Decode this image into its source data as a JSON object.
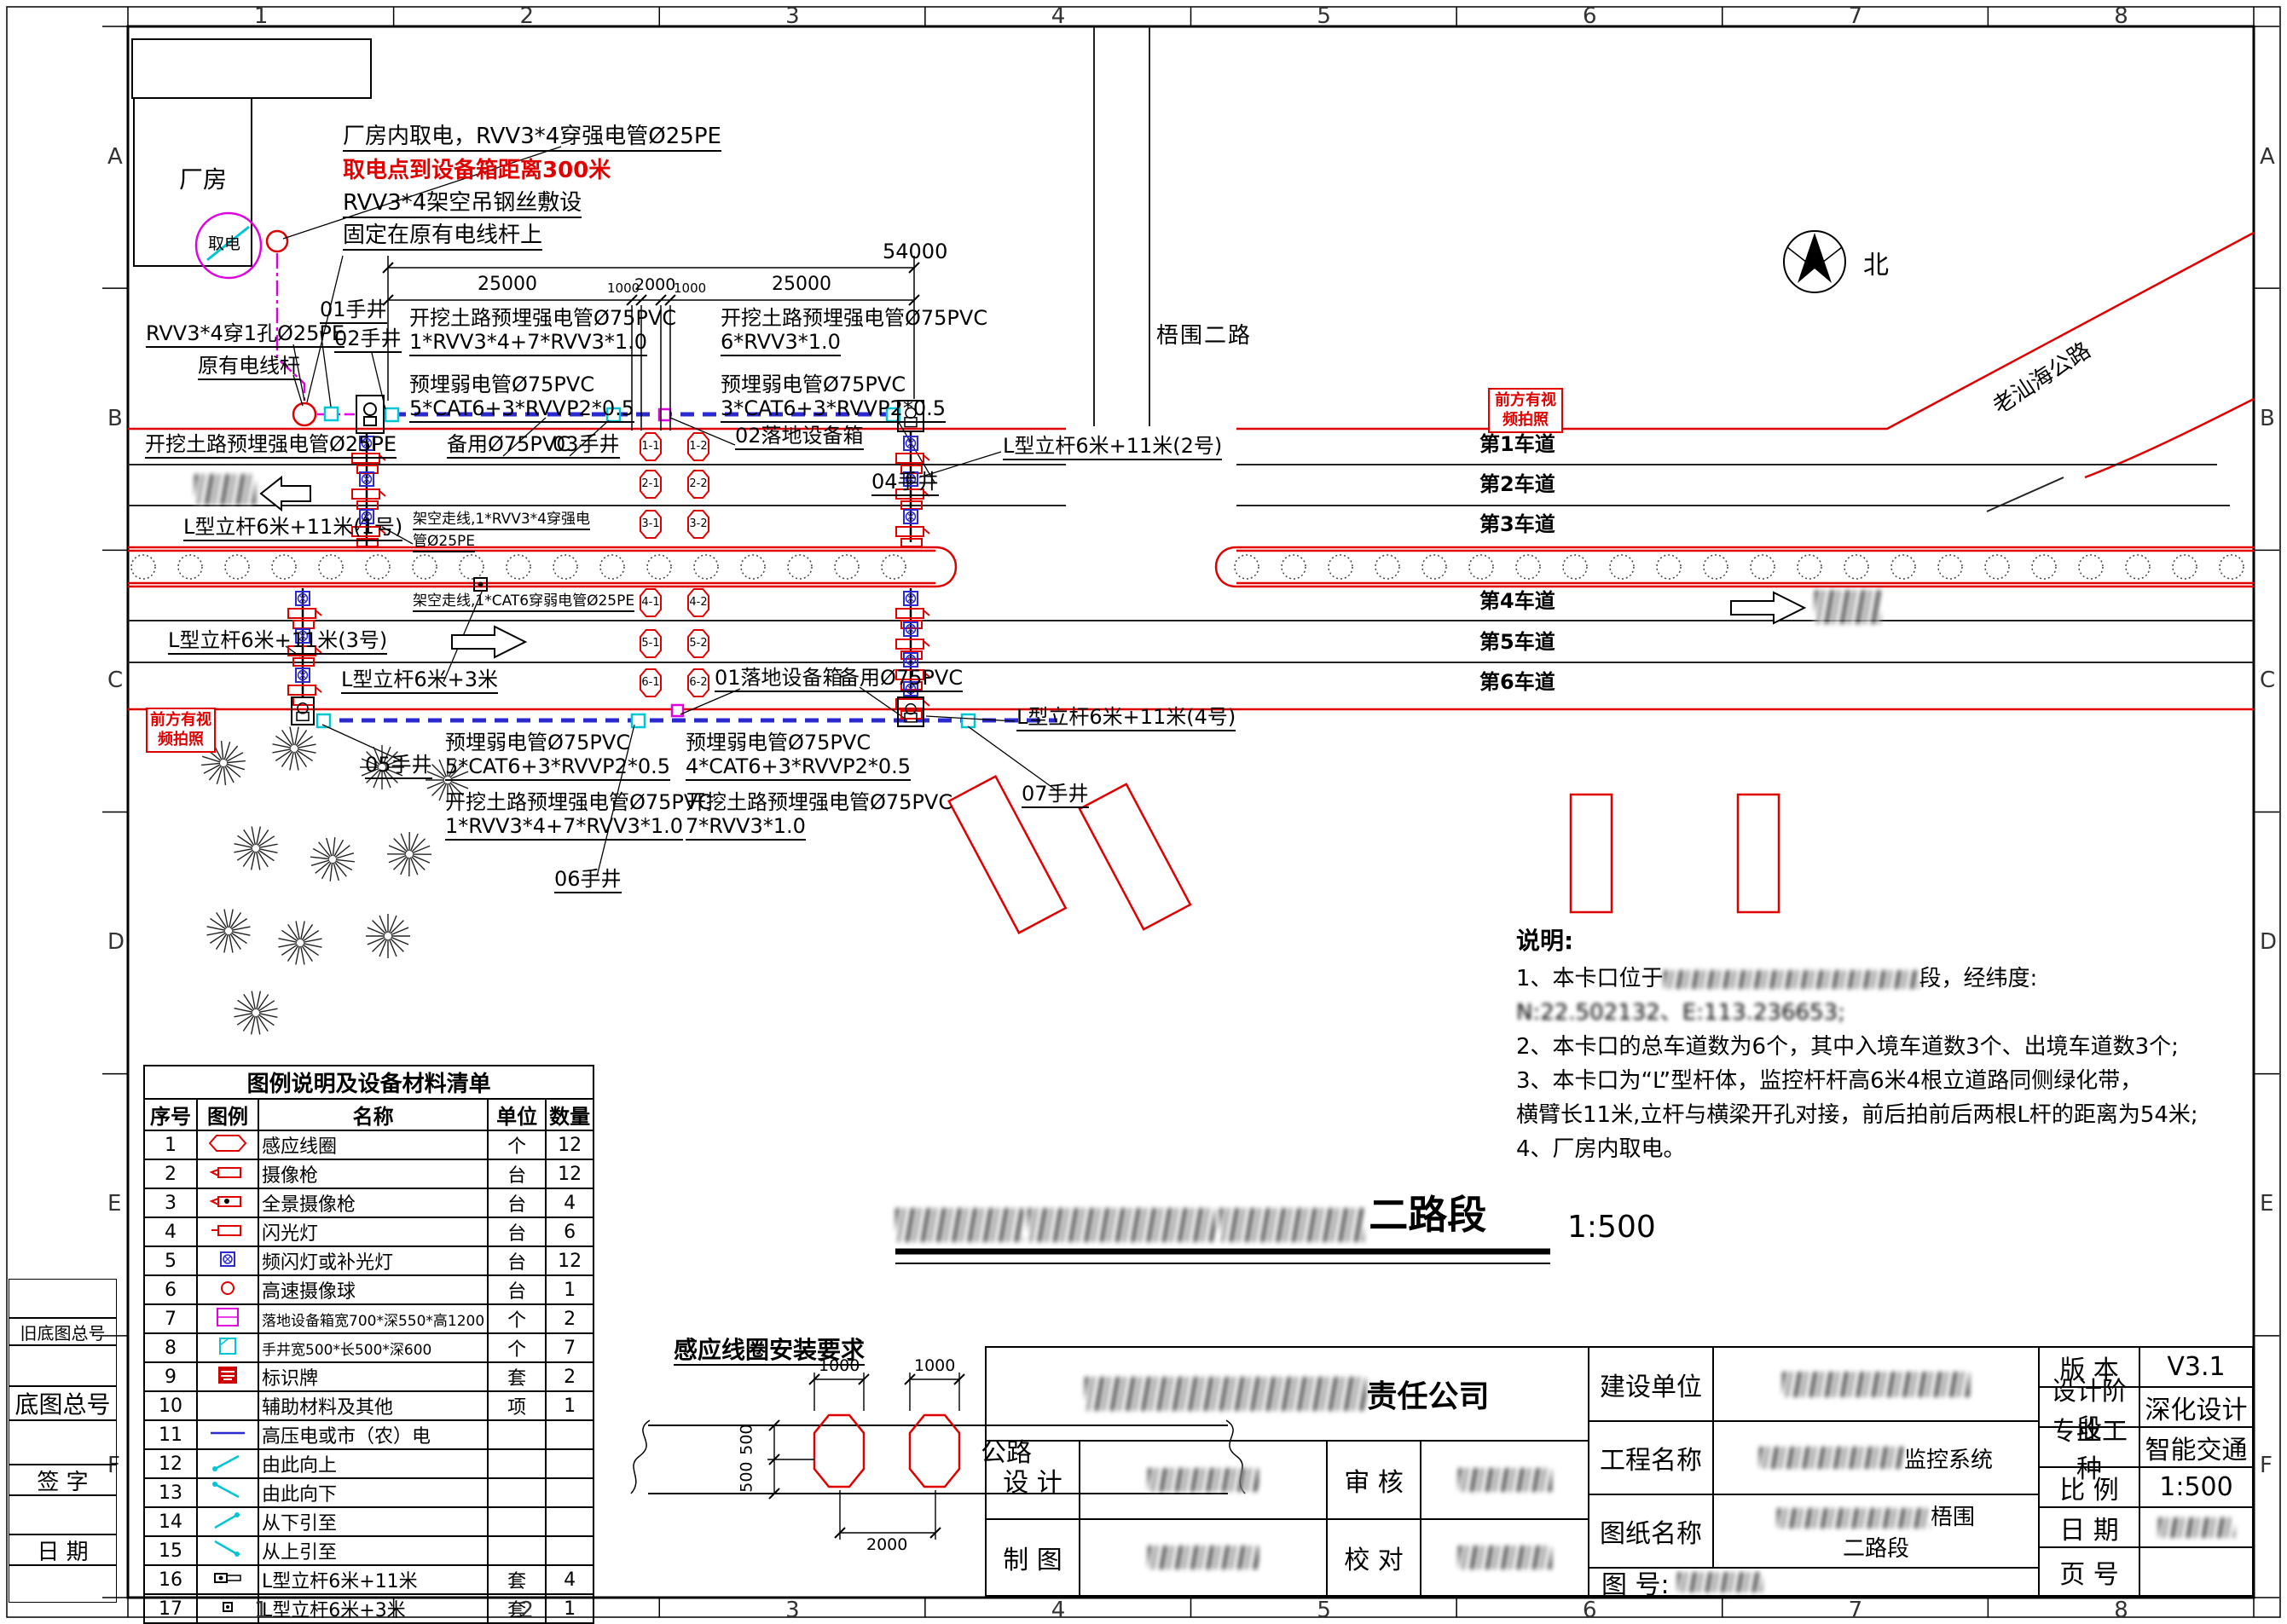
{
  "sheet": {
    "zone_cols": [
      "1",
      "2",
      "3",
      "4",
      "5",
      "6",
      "7",
      "8"
    ],
    "zone_rows": [
      "A",
      "B",
      "C",
      "D",
      "E",
      "F"
    ]
  },
  "plan": {
    "factory": "厂房",
    "power_tap": "取电",
    "annotations": {
      "tap1": "厂房内取电，RVV3*4穿强电管Ø25PE",
      "tap2": "取电点到设备箱距离300米",
      "tap3": "RVV3*4架空吊钢丝敷设",
      "tap4": "固定在原有电线杆上",
      "rvv_hole": "RVV3*4穿1孔Ø25PE",
      "old_pole": "原有电线杆",
      "dig_strong_25": "开挖土路预埋强电管Ø25PE",
      "spare_pvc_top": "备用Ø75PVC",
      "spare_pvc_bottom": "备用Ø75PVC",
      "aerial_strong_1": "架空走线,1*RVV3*4穿强电",
      "aerial_strong_2": "管Ø25PE",
      "aerial_weak": "架空走线,1*CAT6穿弱电管Ø25PE",
      "sign_line1": "前方有视",
      "sign_line2": "频拍照"
    },
    "handwells": {
      "h01": "01手井",
      "h02": "02手井",
      "h03": "03手井",
      "h04": "04手井",
      "h05": "05手井",
      "h06": "06手井",
      "h07": "07手井"
    },
    "cabinets": {
      "c01": "01落地设备箱",
      "c02": "02落地设备箱"
    },
    "poles": {
      "p1": "L型立杆6米+11米(1号)",
      "p2": "L型立杆6米+11米(2号)",
      "p3": "L型立杆6米+11米(3号)",
      "p4": "L型立杆6米+11米(4号)",
      "ps": "L型立杆6米+3米"
    },
    "conduits": {
      "tl1a": "开挖土路预埋强电管Ø75PVC",
      "tl1b": "1*RVV3*4+7*RVV3*1.0",
      "tl2a": "预埋弱电管Ø75PVC",
      "tl2b": "5*CAT6+3*RVVP2*0.5",
      "tr1a": "开挖土路预埋强电管Ø75PVC",
      "tr1b": "6*RVV3*1.0",
      "tr2a": "预埋弱电管Ø75PVC",
      "tr2b": "3*CAT6+3*RVVP2*0.5",
      "bl1a": "预埋弱电管Ø75PVC",
      "bl1b": "5*CAT6+3*RVVP2*0.5",
      "bl2a": "开挖土路预埋强电管Ø75PVC",
      "bl2b": "1*RVV3*4+7*RVV3*1.0",
      "br1a": "预埋弱电管Ø75PVC",
      "br1b": "4*CAT6+3*RVVP2*0.5",
      "br2a": "开挖土路预埋强电管Ø75PVC",
      "br2b": "7*RVV3*1.0"
    },
    "dimensions": {
      "total": "54000",
      "segments": [
        "25000",
        "1000",
        "2000",
        "1000",
        "25000"
      ]
    },
    "roads": {
      "cross": "梧围二路",
      "highway": "老汕海公路",
      "north": "北"
    },
    "lanes": [
      "第1车道",
      "第2车道",
      "第3车道",
      "第4车道",
      "第5车道",
      "第6车道"
    ],
    "coils": [
      "1-1",
      "1-2",
      "2-1",
      "2-2",
      "3-1",
      "3-2",
      "4-1",
      "4-2",
      "5-1",
      "5-2",
      "6-1",
      "6-2"
    ]
  },
  "legend": {
    "title": "图例说明及设备材料清单",
    "headers": [
      "序号",
      "图例",
      "名称",
      "单位",
      "数量"
    ],
    "rows": [
      {
        "no": "1",
        "icon": "loop",
        "name": "感应线圈",
        "unit": "个",
        "qty": "12"
      },
      {
        "no": "2",
        "icon": "camera",
        "name": "摄像枪",
        "unit": "台",
        "qty": "12"
      },
      {
        "no": "3",
        "icon": "pano",
        "name": "全景摄像枪",
        "unit": "台",
        "qty": "4"
      },
      {
        "no": "4",
        "icon": "flash",
        "name": "闪光灯",
        "unit": "台",
        "qty": "6"
      },
      {
        "no": "5",
        "icon": "strobe",
        "name": "频闪灯或补光灯",
        "unit": "台",
        "qty": "12"
      },
      {
        "no": "6",
        "icon": "ball",
        "name": "高速摄像球",
        "unit": "台",
        "qty": "1"
      },
      {
        "no": "7",
        "icon": "cabinet",
        "name": "落地设备箱宽700*深550*高1200",
        "unit": "个",
        "qty": "2"
      },
      {
        "no": "8",
        "icon": "handhole",
        "name": "手井宽500*长500*深600",
        "unit": "个",
        "qty": "7"
      },
      {
        "no": "9",
        "icon": "sign",
        "name": "标识牌",
        "unit": "套",
        "qty": "2"
      },
      {
        "no": "10",
        "icon": "none",
        "name": "辅助材料及其他",
        "unit": "项",
        "qty": "1"
      },
      {
        "no": "11",
        "icon": "hvline",
        "name": "高压电或市（农）电",
        "unit": "",
        "qty": ""
      },
      {
        "no": "12",
        "icon": "arr-up",
        "name": "由此向上",
        "unit": "",
        "qty": ""
      },
      {
        "no": "13",
        "icon": "arr-down",
        "name": "由此向下",
        "unit": "",
        "qty": ""
      },
      {
        "no": "14",
        "icon": "arr-from-below",
        "name": "从下引至",
        "unit": "",
        "qty": ""
      },
      {
        "no": "15",
        "icon": "arr-from-above",
        "name": "从上引至",
        "unit": "",
        "qty": ""
      },
      {
        "no": "16",
        "icon": "pole-l",
        "name": "L型立杆6米+11米",
        "unit": "套",
        "qty": "4"
      },
      {
        "no": "17",
        "icon": "pole-s",
        "name": "L型立杆6米+3米",
        "unit": "套",
        "qty": "1"
      }
    ]
  },
  "notes": {
    "title": "说明:",
    "lines": [
      {
        "pre": "1、本卡口位于",
        "blur": 300,
        "post": "段，经纬度:"
      },
      {
        "text": "N:22.502132、E:113.236653;",
        "halfblur": true
      },
      {
        "text": "2、本卡口的总车道数为6个，其中入境车道数3个、出境车道数3个;"
      },
      {
        "text": "3、本卡口为“L”型杆体，监控杆杆高6米4根立道路同侧绿化带，"
      },
      {
        "text": "横臂长11米,立杆与横梁开孔对接，前后拍前后两根L杆的距离为54米;"
      },
      {
        "text": "4、厂房内取电。"
      }
    ]
  },
  "detail": {
    "title": "感应线圈安装要求",
    "road": "公路",
    "dim_top1": "1000",
    "dim_top2": "1000",
    "dim_left1": "500",
    "dim_left2": "500",
    "dim_bottom": "2000"
  },
  "main_title": {
    "visible_end": "二路段",
    "scale": "1:500"
  },
  "title_block": {
    "company_suffix": "责任公司",
    "design": "设  计",
    "review": "审  核",
    "draft": "制  图",
    "check": "校  对",
    "owner": "建设单位",
    "project": "工程名称",
    "drawing": "图纸名称",
    "number": "图 号:",
    "project_suffix": "监控系统",
    "drawing_suffix1": "梧围",
    "drawing_line2": "二路段",
    "version_label": "版  本",
    "version": "V3.1",
    "stage_label": "设计阶段",
    "stage": "深化设计",
    "trade_label": "专业工种",
    "trade": "智能交通",
    "scale_label": "比  例",
    "scale": "1:500",
    "date_label": "日  期",
    "page_label": "页  号"
  },
  "margin": {
    "old_base_no": "旧底图总号",
    "base_no": "底图总号",
    "signature": "签 字",
    "date": "日 期"
  }
}
